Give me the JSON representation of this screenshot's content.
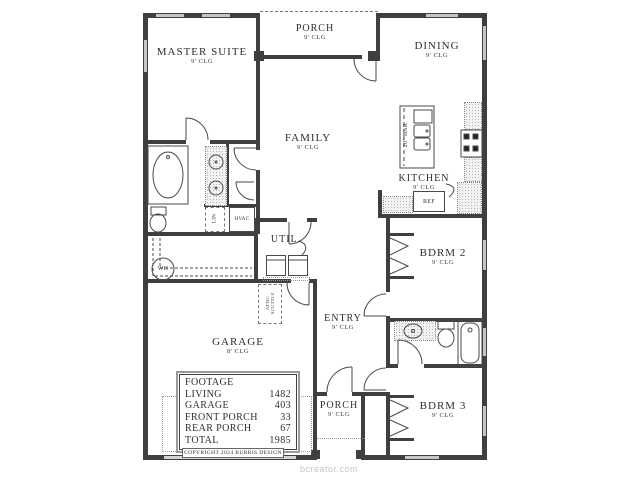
{
  "watermark": "bcreator.com",
  "copyright_label": "COPYRIGHT 2024 BURRIS DESIGN",
  "rooms": {
    "master_suite": {
      "name": "MASTER SUITE",
      "clg": "9' CLG"
    },
    "rear_porch": {
      "name": "PORCH",
      "clg": "9' CLG"
    },
    "dining": {
      "name": "DINING",
      "clg": "9' CLG"
    },
    "family": {
      "name": "FAMILY",
      "clg": "9' CLG"
    },
    "kitchen": {
      "name": "KITCHEN",
      "clg": "9' CLG"
    },
    "bdrm2": {
      "name": "BDRM 2",
      "clg": "9' CLG"
    },
    "bdrm3": {
      "name": "BDRM 3",
      "clg": "9' CLG"
    },
    "entry": {
      "name": "ENTRY",
      "clg": "9' CLG"
    },
    "util": {
      "name": "UTIL."
    },
    "garage": {
      "name": "GARAGE",
      "clg": "8' CLG"
    },
    "front_porch": {
      "name": "PORCH",
      "clg": "9' CLG"
    }
  },
  "fixtures": {
    "dishwasher": "DW",
    "bar": "20\" BAR",
    "refrigerator": "REF",
    "linen": "LIN",
    "hvac": "HVAC",
    "water_heater": "WH",
    "attic_scuttle": "ATTIC SCUTTLE"
  },
  "footage_table": {
    "title": "FOOTAGE",
    "rows": [
      {
        "label": "LIVING",
        "value": "1482"
      },
      {
        "label": "GARAGE",
        "value": "403"
      },
      {
        "label": "FRONT PORCH",
        "value": "33"
      },
      {
        "label": "REAR PORCH",
        "value": "67"
      },
      {
        "label": "TOTAL",
        "value": "1985"
      }
    ]
  },
  "colors": {
    "wall": "#3f3f3f",
    "text": "#2e2e2e",
    "watermark": "#c6c6c6"
  }
}
